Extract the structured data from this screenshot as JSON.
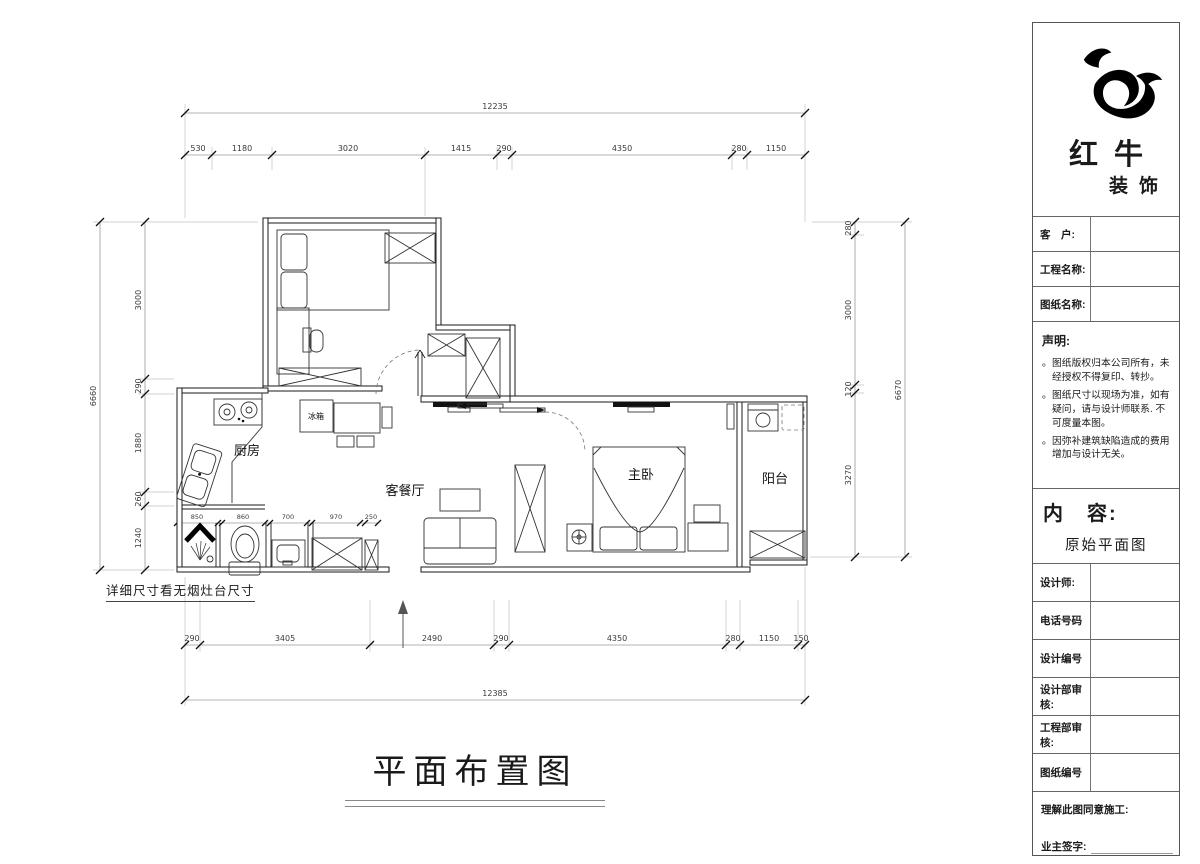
{
  "colors": {
    "ink": "#1a1a1a",
    "dim_line": "#9a9a9a",
    "background": "#ffffff"
  },
  "company": {
    "name_top": "红牛",
    "name_bottom": "装饰"
  },
  "titleblock": {
    "fields": {
      "customer": "客　户:",
      "project": "工程名称:",
      "drawing": "图纸名称:"
    },
    "statement": {
      "heading": "声明:",
      "items": [
        "图纸版权归本公司所有，未经授权不得复印、转抄。",
        "图纸尺寸以现场为准，如有疑问，请与设计师联系. 不可度量本图。",
        "因弥补建筑缺陷造成的费用增加与设计无关。"
      ]
    },
    "content": {
      "label": "内　容:",
      "value": "原始平面图"
    },
    "rows": [
      {
        "label": "设计师:"
      },
      {
        "label": "电话号码"
      },
      {
        "label": "设计编号"
      },
      {
        "label": "设计部审核:"
      },
      {
        "label": "工程部审核:"
      },
      {
        "label": "图纸编号"
      }
    ],
    "footer": {
      "line1": "理解此图同意施工:",
      "line2": "业主签字:"
    }
  },
  "plan": {
    "title": "平面布置图",
    "note": "详细尺寸看无烟灶台尺寸",
    "rooms": {
      "kitchen": "厨房",
      "fridge": "冰箱",
      "living": "客餐厅",
      "master": "主卧",
      "balcony": "阳台"
    },
    "dims": {
      "top_total": "12235",
      "top": [
        "530",
        "1180",
        "3020",
        "1415",
        "290",
        "4350",
        "280",
        "1150"
      ],
      "bottom": [
        "290",
        "3405",
        "2490",
        "290",
        "4350",
        "280",
        "1150",
        "150"
      ],
      "bottom_total": "12385",
      "left": [
        "3000",
        "290",
        "1880",
        "260",
        "1240"
      ],
      "left_total": "6660",
      "right": [
        "280",
        "3000",
        "120",
        "3270"
      ],
      "right_total": "6670",
      "inner": [
        "850",
        "860",
        "700",
        "970",
        "250"
      ]
    }
  }
}
